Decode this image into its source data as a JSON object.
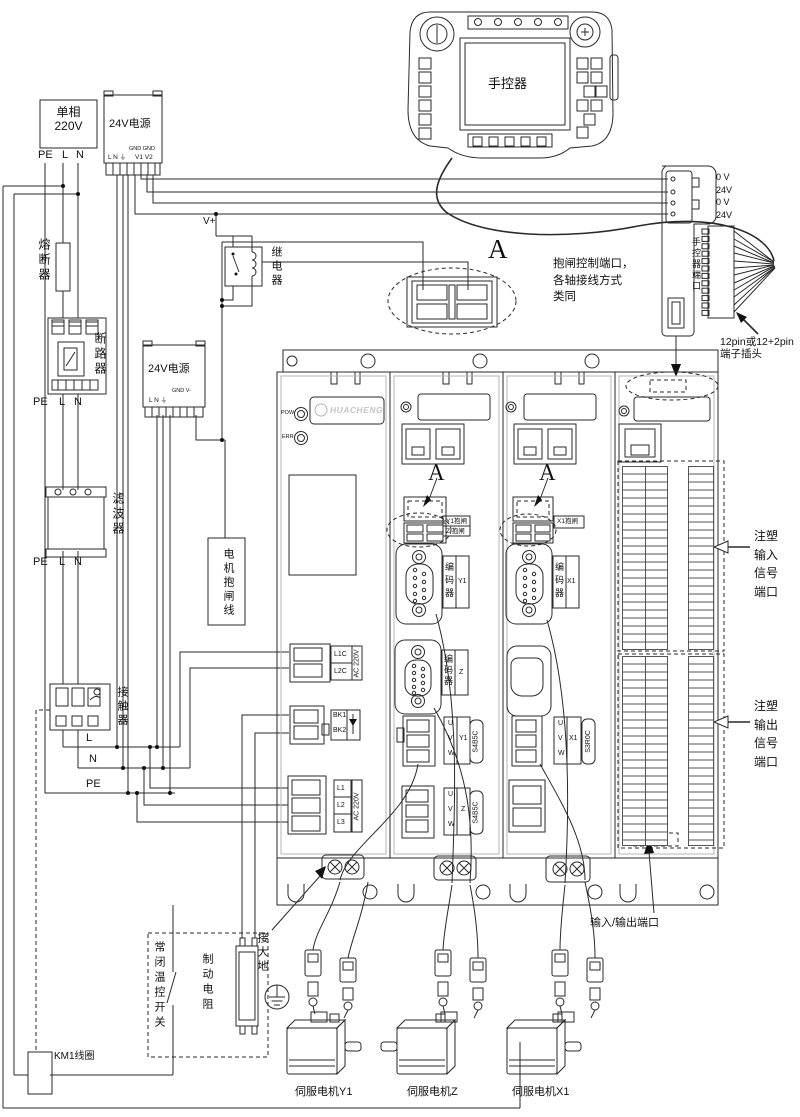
{
  "ac_source": {
    "line1": "单相",
    "line2": "220V"
  },
  "labels": {
    "pe": "PE",
    "l": "L",
    "n": "N",
    "v_plus": "V+"
  },
  "psu1": {
    "title": "24V电源",
    "gnd_row": "GND GND",
    "in_row": "L N ⏚",
    "out_row": "V1 V2"
  },
  "psu2": {
    "title": "24V电源",
    "gnd_row": "GND V-",
    "in_row": "L N ⏚"
  },
  "components": {
    "fuse": "熔断器",
    "breaker": "断路器",
    "filter": "滤波器",
    "contactor": "接触器",
    "relay": "继电器",
    "brake_line": "电机抱闸线",
    "temp_switch": "常闭温控开关",
    "brake_resistor": "制动电阻",
    "km1_coil": "KM1线圈",
    "ground": "接大地"
  },
  "pendant": {
    "title": "手控器",
    "port_label": "手控器端口",
    "pin_labels": [
      "0 V",
      "24V",
      "0 V",
      "24V"
    ],
    "plug_note_line1": "12pin或12+2pin",
    "plug_note_line2": "端子插头"
  },
  "detail_a": {
    "letter": "A",
    "note_line1": "抱闸控制端口，",
    "note_line2": "各轴接线方式",
    "note_line3": "类同"
  },
  "drive": {
    "brand": "HUACHENG",
    "pow_led": "POW",
    "err_led": "ERR",
    "m1": {
      "l1c": "L1C",
      "l2c": "L2C",
      "ac_220v": "AC 220V",
      "bk1": "BK1",
      "bk2": "BK2",
      "l1": "L1",
      "l2": "L2",
      "l3": "L3"
    },
    "m2": {
      "brake_y1": "Y1抱闸",
      "brake_z": "Z 抱闸",
      "encoder": "编码器",
      "axis_y1": "Y1",
      "axis_z": "Z",
      "u": "U",
      "v": "V",
      "w": "W",
      "part_no": "S4B5C"
    },
    "m3": {
      "brake_x1": "X1抱闸",
      "encoder": "编码器",
      "axis_x1": "X1",
      "u": "U",
      "v": "V",
      "w": "W",
      "part_no": "S3R0C"
    }
  },
  "io": {
    "input_label": [
      "注塑",
      "输入",
      "信号",
      "端口"
    ],
    "output_label": [
      "注塑",
      "输出",
      "信号",
      "端口"
    ],
    "port_label": "输入/输出端口"
  },
  "motors": {
    "y1": "伺服电机Y1",
    "z": "伺服电机Z",
    "x1": "伺服电机X1"
  }
}
